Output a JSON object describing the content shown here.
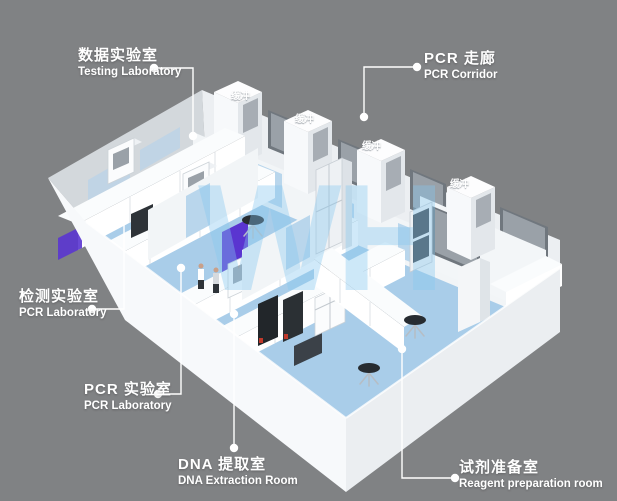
{
  "watermark": "WH",
  "buffer_label": "缓冲",
  "labels": {
    "testing": {
      "zh": "数据实验室",
      "en": "Testing Laboratory"
    },
    "corridor": {
      "zh": "PCR 走廊",
      "en": "PCR Corridor"
    },
    "detection": {
      "zh": "检测实验室",
      "en": "PCR Laboratory"
    },
    "pcr": {
      "zh": "PCR 实验室",
      "en": "PCR Laboratory"
    },
    "dna": {
      "zh": "DNA 提取室",
      "en": "DNA Extraction Room"
    },
    "reagent": {
      "zh": "试剂准备室",
      "en": "Reagent preparation room"
    }
  },
  "colors": {
    "background_gray": "#808284",
    "floor_blue": "#a9cde9",
    "corridor_blue": "#c9dff1",
    "wall_white": "#f4f6f8",
    "glass_gray": "#9aa1a8",
    "bench_top_dark": "#3a4046",
    "accent_purple": "#5a35d0",
    "label_white": "#ffffff",
    "watermark_blue": "#86c8f0"
  }
}
